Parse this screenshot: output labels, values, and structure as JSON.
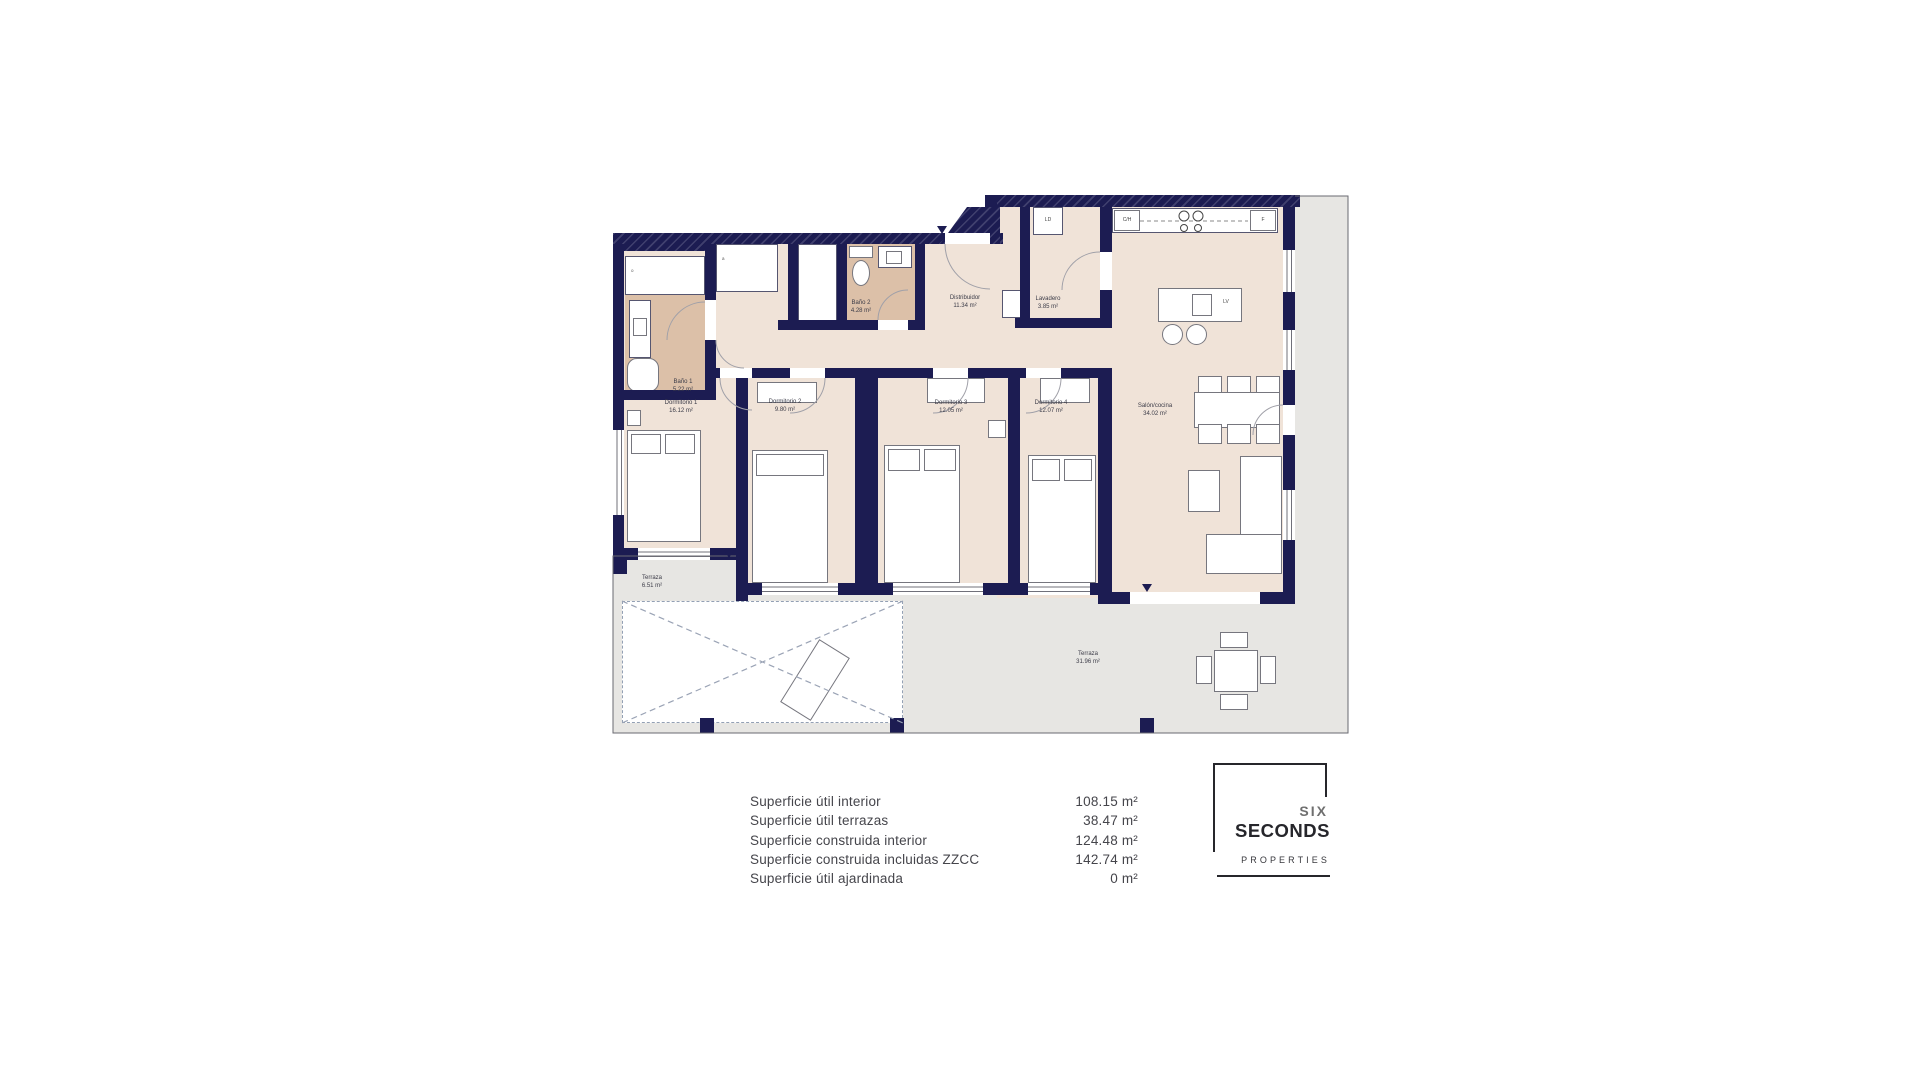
{
  "plan": {
    "rooms": [
      {
        "name": "Baño 1",
        "area": "5.22 m²"
      },
      {
        "name": "Dormitorio 1",
        "area": "16.12 m²"
      },
      {
        "name": "Dormitorio 2",
        "area": "9.80 m²"
      },
      {
        "name": "Dormitorio 3",
        "area": "12.05 m²"
      },
      {
        "name": "Dormitorio 4",
        "area": "12.07 m²"
      },
      {
        "name": "Baño 2",
        "area": "4.28 m²"
      },
      {
        "name": "Distribuidor",
        "area": "11.34 m²"
      },
      {
        "name": "Lavadero",
        "area": "3.85 m²"
      },
      {
        "name": "Salón/cocina",
        "area": "34.02 m²"
      },
      {
        "name": "Terraza",
        "area": "6.51 m²"
      },
      {
        "name": "Terraza",
        "area": "31.96 m²"
      }
    ],
    "appliances": {
      "washing_machine": "LD",
      "oven_column": "C/H",
      "fridge": "F",
      "dishwasher": "LV"
    },
    "marks": {
      "shower": "o",
      "closet": "a"
    }
  },
  "legend": {
    "rows": [
      {
        "label": "Superficie útil interior",
        "value": "108.15 m²"
      },
      {
        "label": "Superficie útil terrazas",
        "value": "38.47 m²"
      },
      {
        "label": "Superficie construida interior",
        "value": "124.48 m²"
      },
      {
        "label": "Superficie construida incluidas ZZCC",
        "value": "142.74 m²"
      },
      {
        "label": "Superficie útil ajardinada",
        "value": "0 m²"
      }
    ]
  },
  "logo": {
    "top": "SIX",
    "middle": "SECONDS",
    "bottom": "PROPERTIES"
  },
  "colors": {
    "wall": "#1c1c52",
    "interior": "#f0e3d8",
    "bathroom": "#dcc0a8",
    "terrace": "#e7e6e3",
    "legend_text": "#45454b"
  }
}
